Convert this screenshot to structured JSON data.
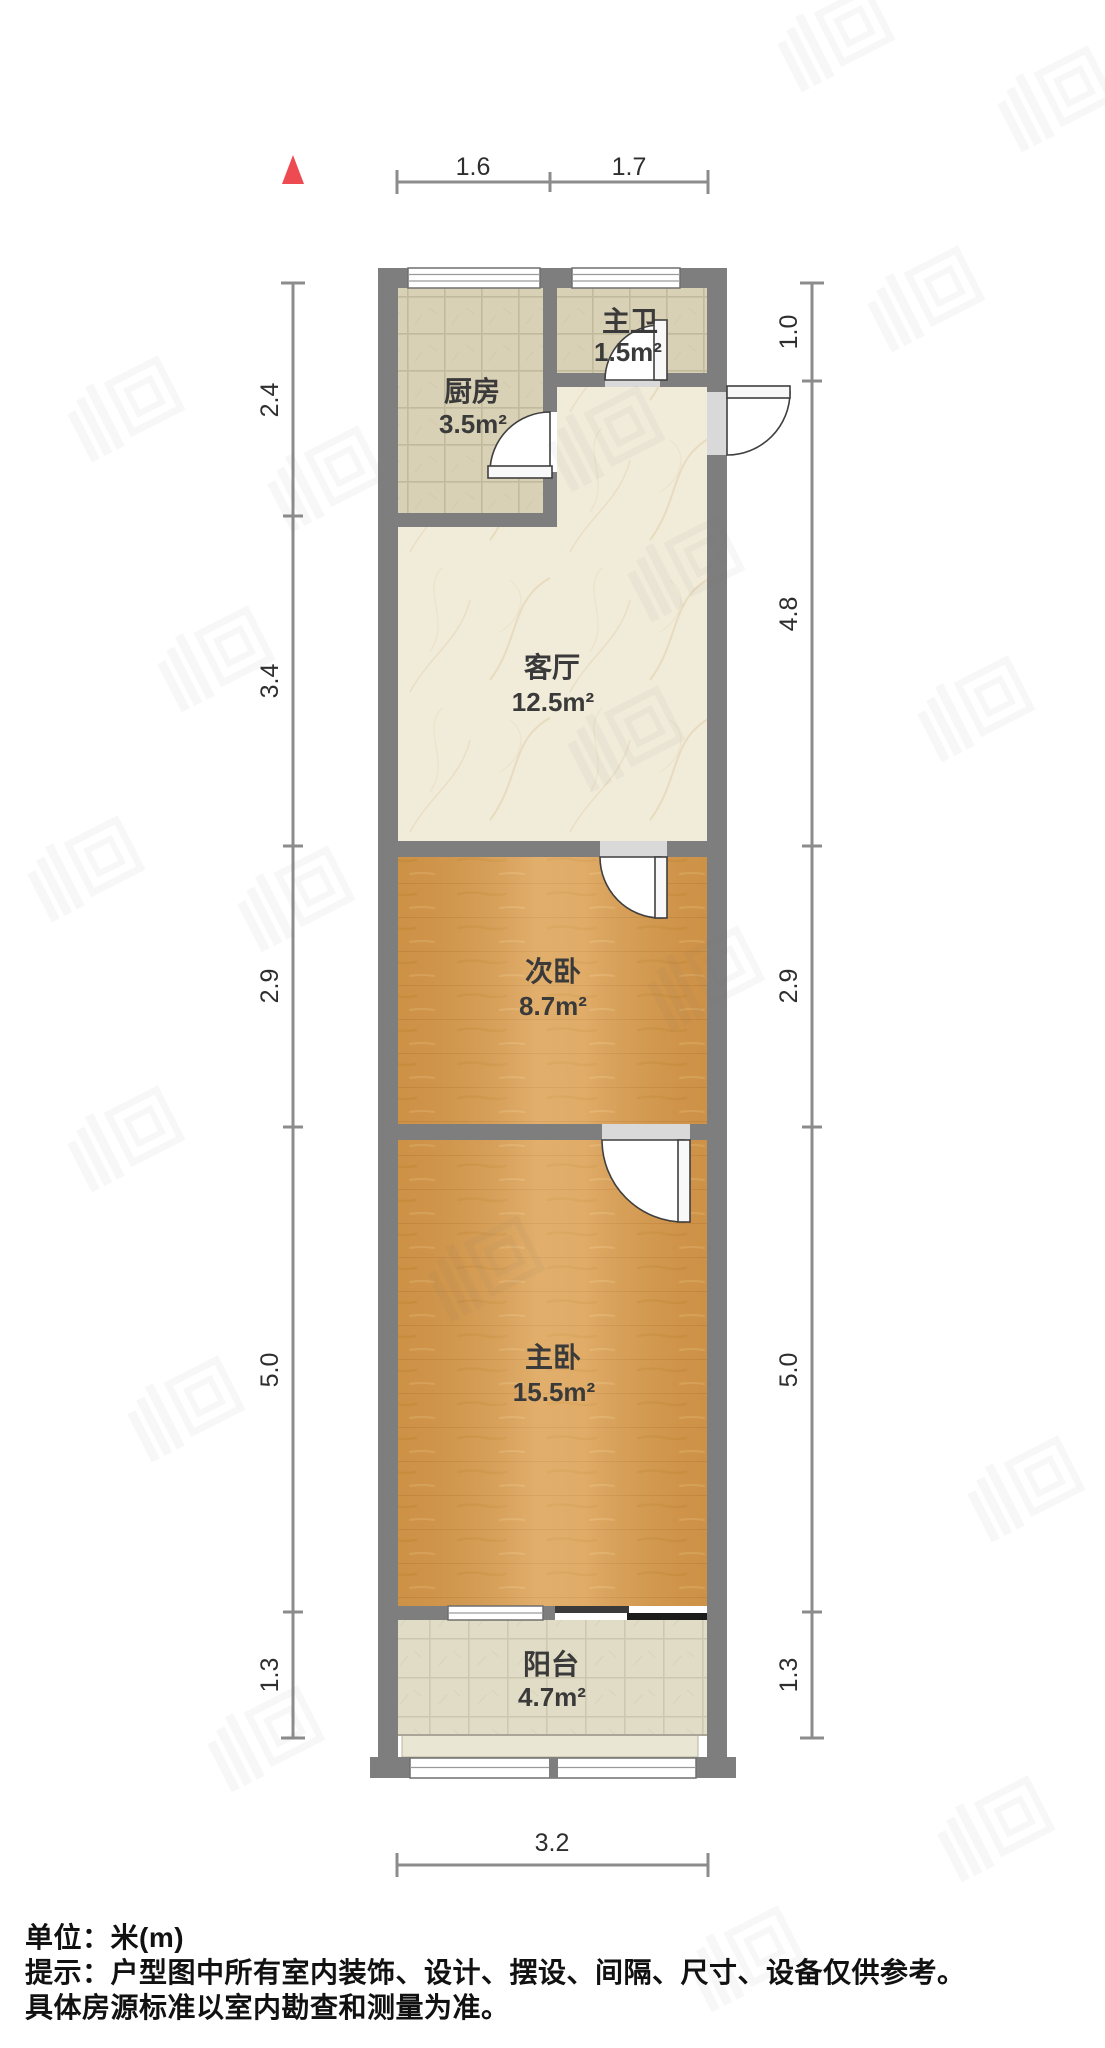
{
  "north_indicator": {
    "symbol": "north-triangle",
    "color": "#ee4a52"
  },
  "rooms": {
    "bathroom": {
      "name": "主卫",
      "area": "1.5m²",
      "floor": "tile"
    },
    "kitchen": {
      "name": "厨房",
      "area": "3.5m²",
      "floor": "tile"
    },
    "living": {
      "name": "客厅",
      "area": "12.5m²",
      "floor": "marble"
    },
    "bedroom2": {
      "name": "次卧",
      "area": "8.7m²",
      "floor": "wood"
    },
    "bedroom1": {
      "name": "主卧",
      "area": "15.5m²",
      "floor": "wood"
    },
    "balcony": {
      "name": "阳台",
      "area": "4.7m²",
      "floor": "tile"
    }
  },
  "dimensions": {
    "top": [
      "1.6",
      "1.7"
    ],
    "left": [
      "2.4",
      "3.4",
      "2.9",
      "5.0",
      "1.3"
    ],
    "right": [
      "1.0",
      "4.8",
      "2.9",
      "5.0",
      "1.3"
    ],
    "bottom": [
      "3.2"
    ]
  },
  "footer": {
    "line1": "单位：米(m)",
    "line2": "提示：户型图中所有室内装饰、设计、摆设、间隔、尺寸、设备仅供参考。",
    "line3": "具体房源标准以室内勘查和测量为准。"
  },
  "colors": {
    "north": "#ee4a52",
    "wall": "#7e7e7e",
    "wood_floor": "#d79a4c",
    "tile_floor": "#d8d1b6",
    "marble_floor": "#f1ebd9",
    "balcony_floor": "#e1dcc6",
    "dim_line": "#8c8c8c",
    "label_text": "#3a3a3a"
  }
}
